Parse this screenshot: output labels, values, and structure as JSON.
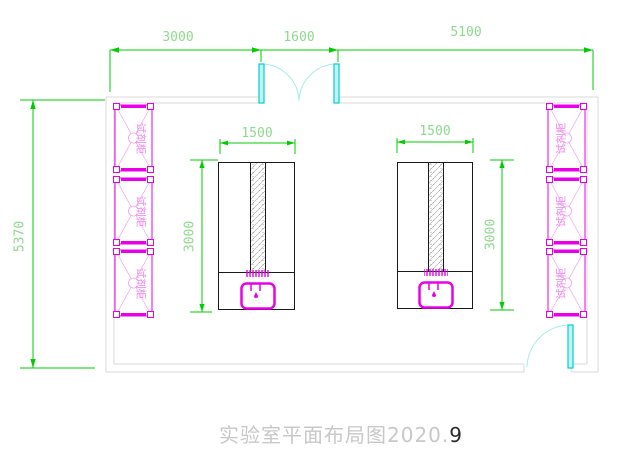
{
  "drawing": {
    "title_main": "实验室平面布局图2020.",
    "title_suffix": "9"
  },
  "dimensions": {
    "top_left": "3000",
    "top_mid": "1600",
    "top_right": "5100",
    "wall_left": "5370",
    "bench_width": "1500",
    "bench_depth": "3000"
  },
  "labels": {
    "reagent_cabinet": "试剂柜"
  },
  "colors": {
    "dimension_green": "#00cc00",
    "furniture_magenta": "#e800e8",
    "door_cyan": "#00d8d8",
    "wall_gray": "#d8d8d8"
  }
}
